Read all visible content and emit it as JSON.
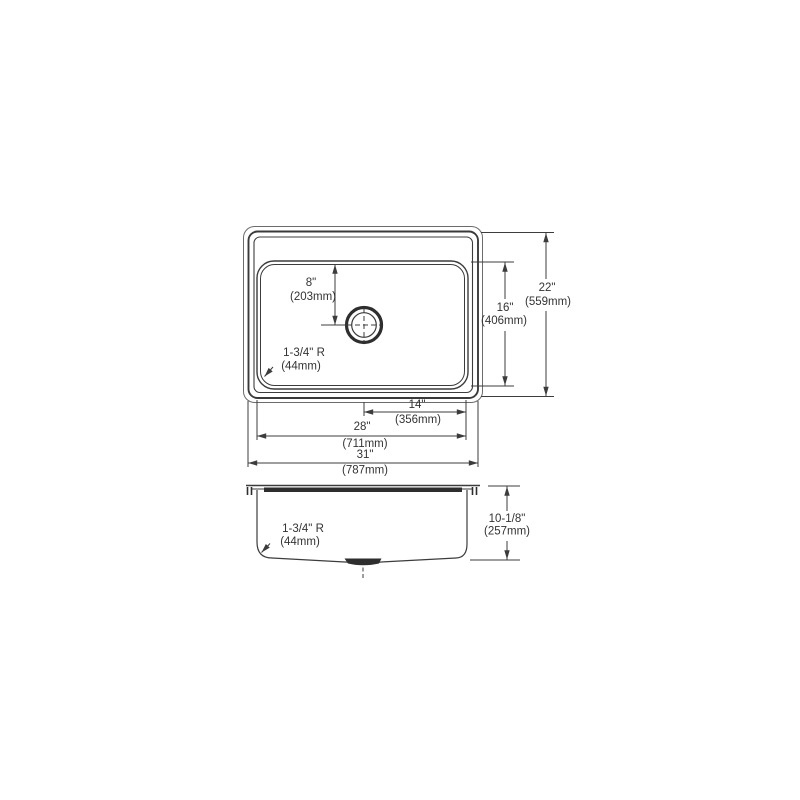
{
  "drawing": {
    "background": "#ffffff",
    "line_color": "#3c3c3c",
    "dark_color": "#2e2e2e",
    "text_color": "#333333"
  },
  "top_view": {
    "drain_offset": {
      "inches": "8\"",
      "mm": "(203mm)"
    },
    "corner_radius": {
      "inches": "1-3/4\" R",
      "mm": "(44mm)"
    },
    "bowl_front_to_back": {
      "inches": "16\"",
      "mm": "(406mm)"
    },
    "overall_front_to_back": {
      "inches": "22\"",
      "mm": "(559mm)"
    },
    "drain_to_bowl_edge": {
      "inches": "14\"",
      "mm": "(356mm)"
    },
    "bowl_width": {
      "inches": "28\"",
      "mm": "(711mm)"
    },
    "overall_width": {
      "inches": "31\"",
      "mm": "(787mm)"
    }
  },
  "side_view": {
    "corner_radius": {
      "inches": "1-3/4\" R",
      "mm": "(44mm)"
    },
    "bowl_depth": {
      "inches": "10-1/8\"",
      "mm": "(257mm)"
    }
  }
}
